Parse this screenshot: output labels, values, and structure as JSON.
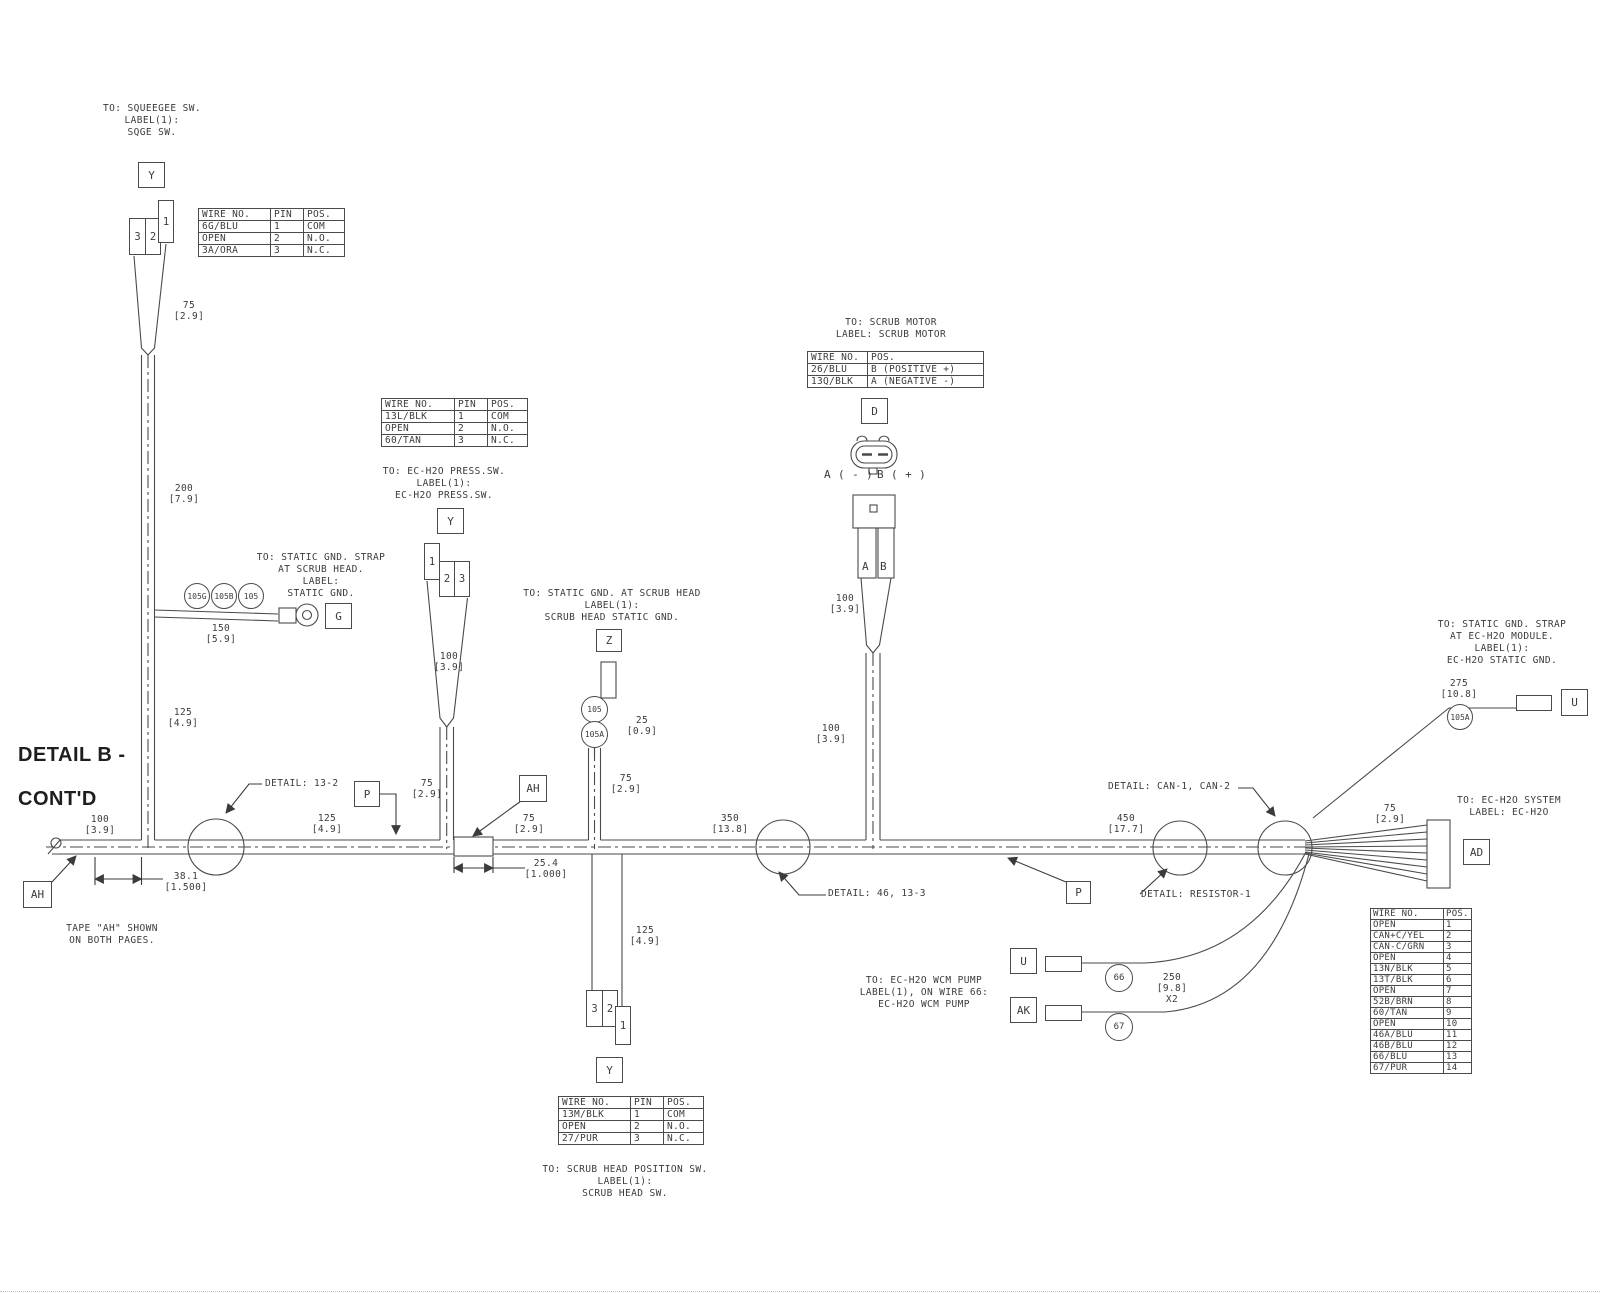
{
  "drawing": {
    "title_line1": "DETAIL B -",
    "title_line2": "CONT'D",
    "note_line1": "TAPE \"AH\" SHOWN",
    "note_line2": "ON BOTH PAGES."
  },
  "callouts": {
    "squeegee": [
      "TO: SQUEEGEE SW.",
      "LABEL(1):",
      "SQGE SW."
    ],
    "static_gnd_scrub_head": [
      "TO: STATIC GND. STRAP",
      "AT SCRUB HEAD.",
      "LABEL:",
      "STATIC GND."
    ],
    "ech2o_press_sw": [
      "TO: EC-H2O PRESS.SW.",
      "LABEL(1):",
      "EC-H2O PRESS.SW."
    ],
    "scrub_head_static_gnd": [
      "TO: STATIC GND. AT SCRUB HEAD",
      "LABEL(1):",
      "SCRUB HEAD STATIC GND."
    ],
    "scrub_motor": [
      "TO: SCRUB MOTOR",
      "LABEL: SCRUB MOTOR"
    ],
    "ech2o_static_gnd": [
      "TO: STATIC GND. STRAP",
      "AT EC-H2O MODULE.",
      "LABEL(1):",
      "EC-H2O STATIC GND."
    ],
    "ech2o_system": [
      "TO: EC-H2O SYSTEM",
      "LABEL: EC-H2O"
    ],
    "ech2o_wcm_pump": [
      "TO: EC-H2O WCM PUMP",
      "LABEL(1), ON WIRE 66:",
      "EC-H2O WCM PUMP"
    ],
    "scrub_head_position_sw": [
      "TO: SCRUB HEAD POSITION SW.",
      "LABEL(1):",
      "SCRUB HEAD SW."
    ]
  },
  "details": {
    "d13_2": "DETAIL: 13-2",
    "d46_13_3": "DETAIL: 46, 13-3",
    "can": "DETAIL: CAN-1, CAN-2",
    "resistor": "DETAIL: RESISTOR-1"
  },
  "refs": {
    "y": "Y",
    "g": "G",
    "z": "Z",
    "d": "D",
    "p": "P",
    "ah": "AH",
    "u": "U",
    "ak": "AK",
    "ad": "AD"
  },
  "splices": {
    "s105g": "105G",
    "s105b": "105B",
    "s105": "105",
    "s105a": "105A",
    "s66": "66",
    "s67": "67"
  },
  "pins": {
    "p1": "1",
    "p2": "2",
    "p3": "3",
    "pa": "A",
    "pb": "B",
    "a_neg": "A ( - )",
    "b_pos": "B ( + )"
  },
  "dims": {
    "d75": [
      "75",
      "[2.9]"
    ],
    "d100": [
      "100",
      "[3.9]"
    ],
    "d125": [
      "125",
      "[4.9]"
    ],
    "d150": [
      "150",
      "[5.9]"
    ],
    "d200": [
      "200",
      "[7.9]"
    ],
    "d25": [
      "25",
      "[0.9]"
    ],
    "d275": [
      "275",
      "[10.8]"
    ],
    "d350": [
      "350",
      "[13.8]"
    ],
    "d450": [
      "450",
      "[17.7]"
    ],
    "d38_1": [
      "38.1",
      "[1.500]"
    ],
    "d25_4": [
      "25.4",
      "[1.000]"
    ],
    "d250": [
      "250",
      "[9.8]",
      "X2"
    ]
  },
  "tables": {
    "squeegee_sw": {
      "headers": [
        "WIRE NO.",
        "PIN",
        "POS."
      ],
      "rows": [
        [
          "6G/BLU",
          "1",
          "COM"
        ],
        [
          "OPEN",
          "2",
          "N.O."
        ],
        [
          "3A/ORA",
          "3",
          "N.C."
        ]
      ]
    },
    "ech2o_press_sw": {
      "headers": [
        "WIRE NO.",
        "PIN",
        "POS."
      ],
      "rows": [
        [
          "13L/BLK",
          "1",
          "COM"
        ],
        [
          "OPEN",
          "2",
          "N.O."
        ],
        [
          "60/TAN",
          "3",
          "N.C."
        ]
      ]
    },
    "scrub_motor": {
      "headers": [
        "WIRE NO.",
        "POS."
      ],
      "rows": [
        [
          "26/BLU",
          "B (POSITIVE +)"
        ],
        [
          "13Q/BLK",
          "A (NEGATIVE -)"
        ]
      ]
    },
    "scrub_head_position_sw": {
      "headers": [
        "WIRE NO.",
        "PIN",
        "POS."
      ],
      "rows": [
        [
          "13M/BLK",
          "1",
          "COM"
        ],
        [
          "OPEN",
          "2",
          "N.O."
        ],
        [
          "27/PUR",
          "3",
          "N.C."
        ]
      ]
    },
    "ech2o_system": {
      "headers": [
        "WIRE NO.",
        "POS."
      ],
      "rows": [
        [
          "OPEN",
          "1"
        ],
        [
          "CAN+C/YEL",
          "2"
        ],
        [
          "CAN-C/GRN",
          "3"
        ],
        [
          "OPEN",
          "4"
        ],
        [
          "13N/BLK",
          "5"
        ],
        [
          "13T/BLK",
          "6"
        ],
        [
          "OPEN",
          "7"
        ],
        [
          "52B/BRN",
          "8"
        ],
        [
          "60/TAN",
          "9"
        ],
        [
          "OPEN",
          "10"
        ],
        [
          "46A/BLU",
          "11"
        ],
        [
          "46B/BLU",
          "12"
        ],
        [
          "66/BLU",
          "13"
        ],
        [
          "67/PUR",
          "14"
        ]
      ]
    }
  }
}
